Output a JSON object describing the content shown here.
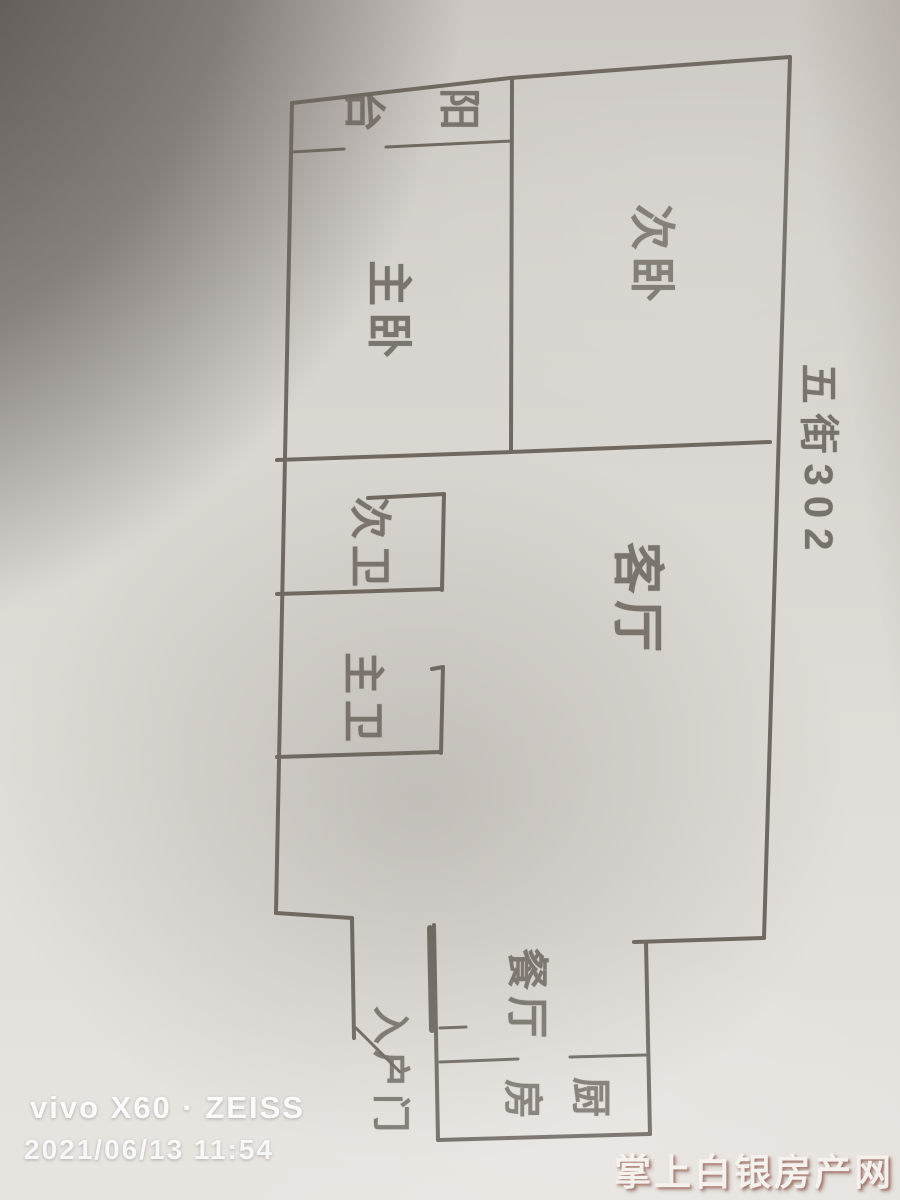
{
  "photo": {
    "device_watermark": "vivo X60 · ZEISS",
    "datetime_watermark": "2021/06/13 11:54",
    "site_watermark": "掌上白银房产网",
    "annotation_address": "五街302"
  },
  "floor_plan": {
    "rooms": {
      "balcony": {
        "name": "阳台",
        "first_char": "阳",
        "second_char": "台"
      },
      "master_bedroom": "主卧",
      "secondary_bedroom": "次卧",
      "living_room": "客厅",
      "secondary_bathroom": "次卫",
      "master_bathroom": "主卫",
      "dining_room": "餐厅",
      "kitchen": {
        "name": "厨房",
        "first_char": "厨",
        "second_char": "房"
      },
      "entry_door": "入户门"
    },
    "pencil_color": "#6f6962"
  },
  "colors": {
    "paper": "#ddd9d4",
    "corner_shadow": "#26201c",
    "watermark_white": "#ffffff",
    "site_watermark_shadow": "#8c3c2d"
  }
}
